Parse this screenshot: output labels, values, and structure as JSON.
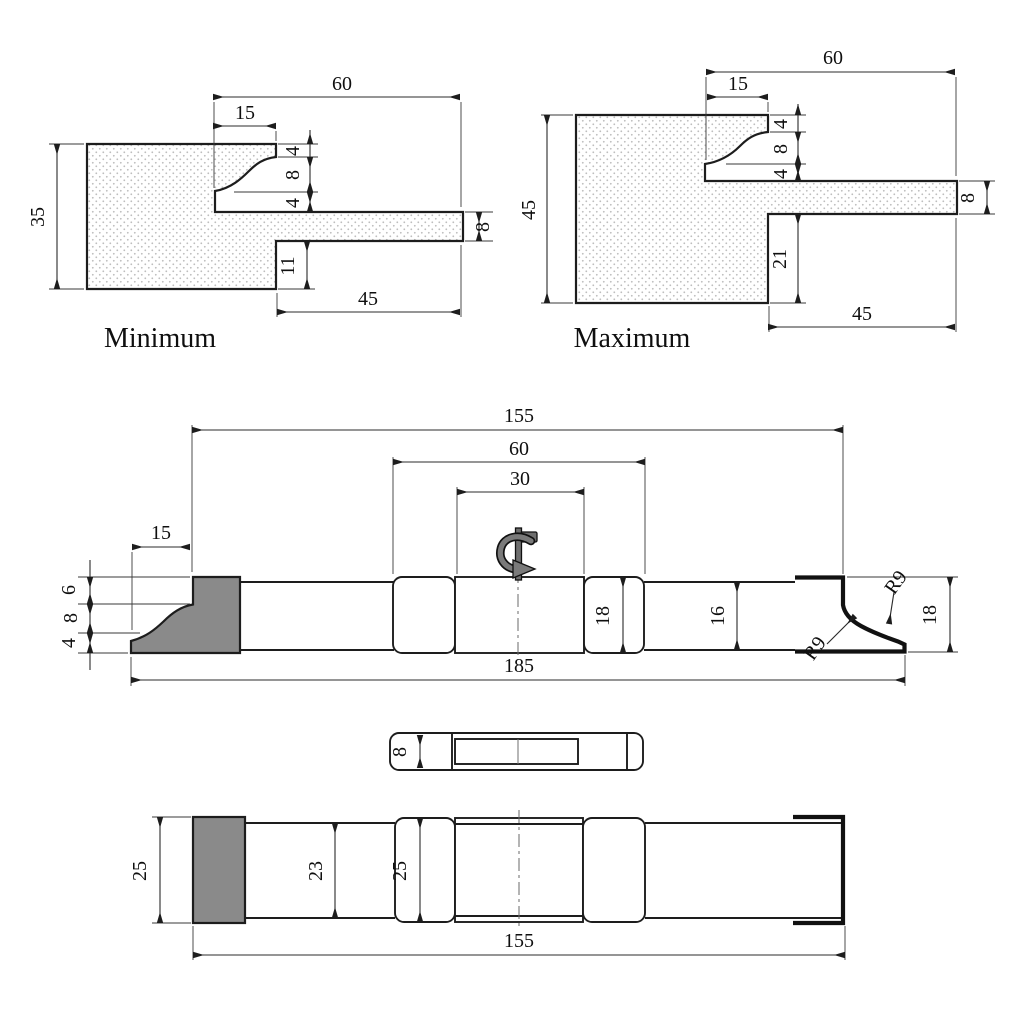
{
  "drawing": {
    "background": "#ffffff",
    "line_color": "#1d1d1d",
    "cutter_fill": "#8a8a8a",
    "views": {
      "minimum": {
        "caption": "Minimum",
        "dims": {
          "overall_width": "60",
          "profile_width": "15",
          "height": "35",
          "step_top": "4",
          "ogee_height": "8",
          "step_bottom": "4",
          "arm_thickness": "8",
          "lip_depth": "11",
          "arm_length": "45"
        }
      },
      "maximum": {
        "caption": "Maximum",
        "dims": {
          "overall_width": "60",
          "profile_width": "15",
          "height": "45",
          "step_top": "4",
          "ogee_height": "8",
          "step_bottom": "4",
          "arm_thickness": "8",
          "lip_depth": "21",
          "arm_length": "45"
        }
      },
      "side": {
        "dims": {
          "overall_length": "185",
          "body_length": "155",
          "head_span": "60",
          "slot_length": "30",
          "knife_width": "15",
          "knife_step_top": "6",
          "knife_ogee": "8",
          "knife_step_bottom": "4",
          "collar_height": "18",
          "shaft_height": "16",
          "knife_height": "18",
          "radius_upper": "R9",
          "radius_lower": "R9"
        }
      },
      "strip": {
        "dims": {
          "thickness": "8"
        }
      },
      "bottom": {
        "dims": {
          "cutter_width": "25",
          "shaft_width": "23",
          "collar_width": "25",
          "body_length": "155"
        }
      }
    }
  }
}
